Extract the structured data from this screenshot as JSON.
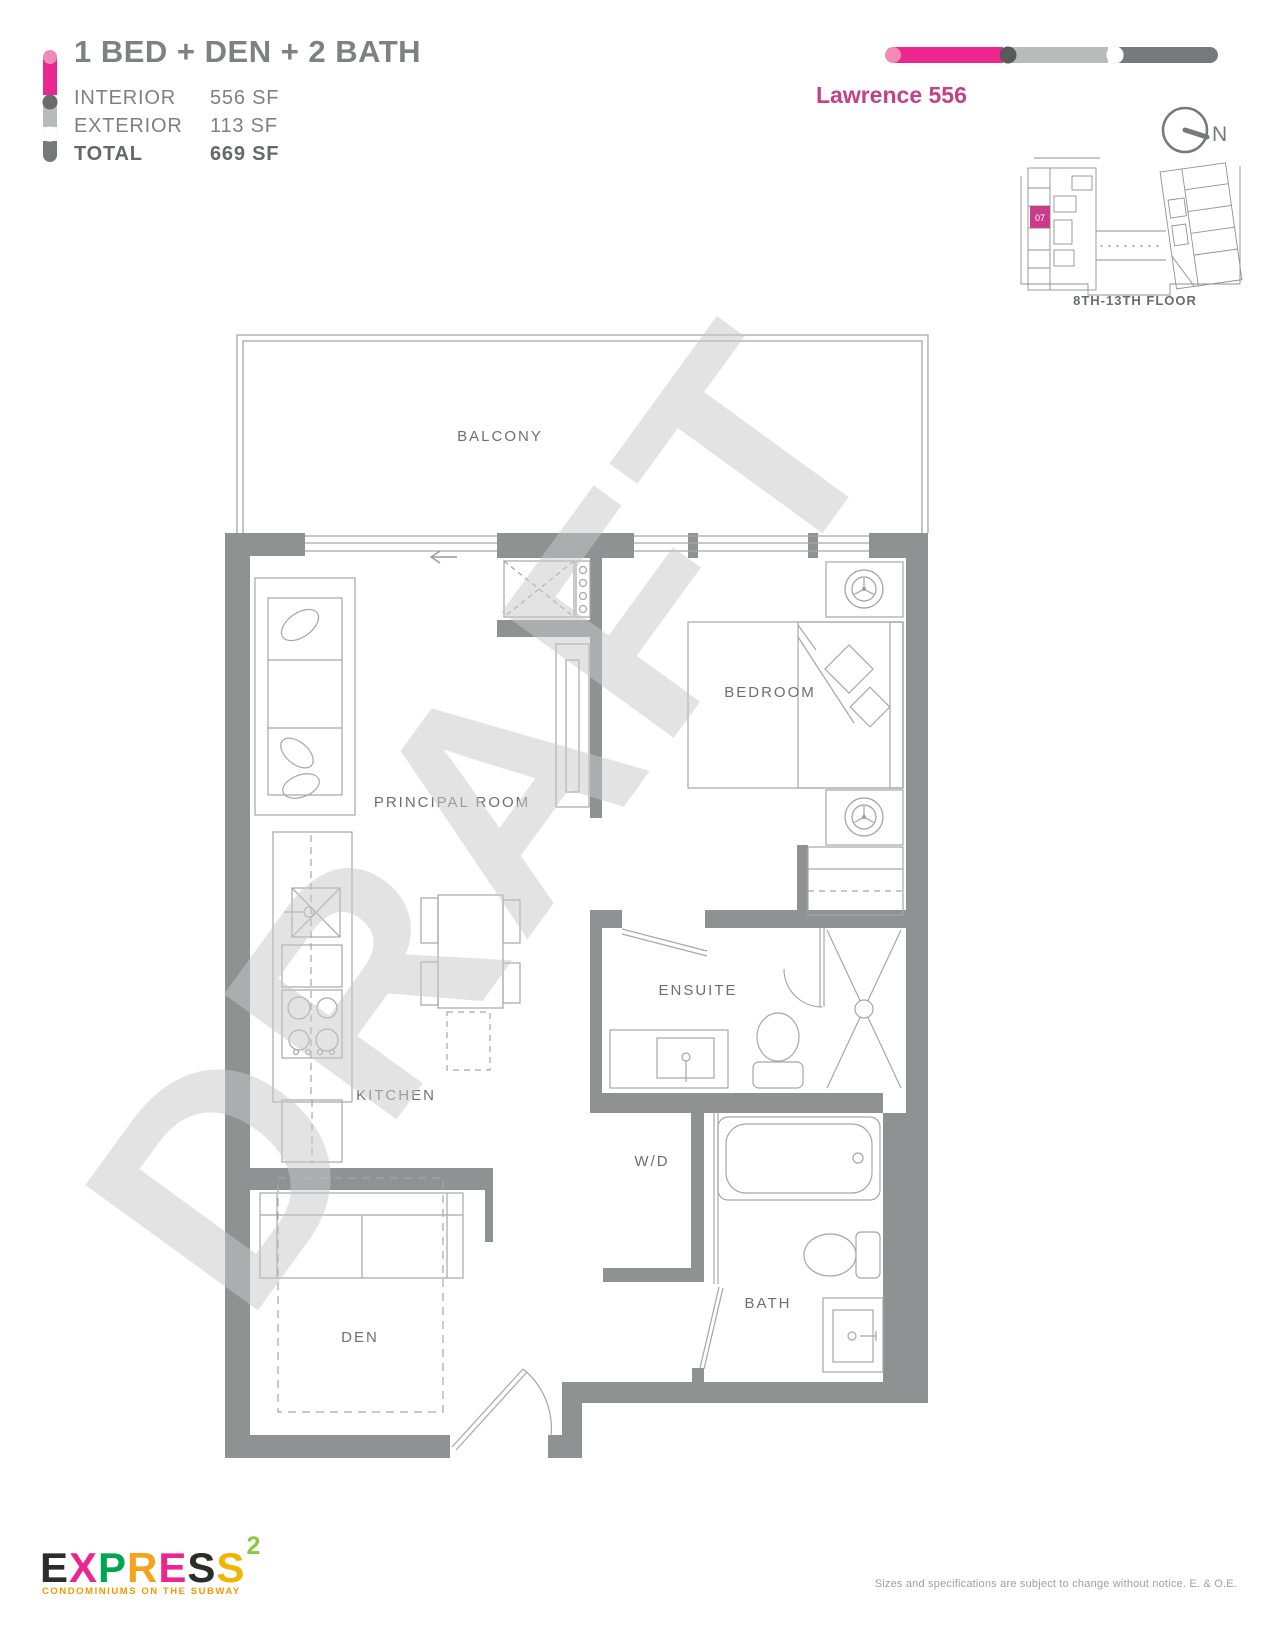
{
  "header": {
    "title": "1 BED + DEN + 2 BATH",
    "stats": [
      {
        "label": "INTERIOR",
        "value": "556 SF"
      },
      {
        "label": "EXTERIOR",
        "value": "113 SF"
      },
      {
        "label": "TOTAL",
        "value": "669 SF"
      }
    ],
    "plan_name": "Lawrence 556"
  },
  "keyplan": {
    "floor_range": "8TH-13TH FLOOR",
    "unit_number": "07",
    "compass_label": "N"
  },
  "floorplan": {
    "watermark": "DRAFT",
    "rooms": [
      {
        "label": "BALCONY"
      },
      {
        "label": "PRINCIPAL ROOM"
      },
      {
        "label": "BEDROOM"
      },
      {
        "label": "ENSUITE"
      },
      {
        "label": "KITCHEN"
      },
      {
        "label": "W/D"
      },
      {
        "label": "DEN"
      },
      {
        "label": "BATH"
      }
    ]
  },
  "footer": {
    "logo_letters": [
      "E",
      "X",
      "P",
      "R",
      "E",
      "S",
      "S"
    ],
    "logo_superscript": "2",
    "tagline": "CONDOMINIUMS ON THE SUBWAY",
    "disclaimer": "Sizes and specifications are subject to change without notice. E. & O.E."
  },
  "colors": {
    "accent_pink": "#EC268F",
    "light_pink_cap": "#F28AB6",
    "plan_name_pink": "#C2418A",
    "keyplan_unit_pink": "#CB3B8C",
    "wall_gray": "#8F9193",
    "line_gray": "#A6A6A6",
    "label_gray": "#6E6F71",
    "bar_dark_gray": "#77787B",
    "bar_light_gray": "#B9BABC",
    "watermark_gray": "#C9C9C9",
    "tagline_orange": "#F49A00"
  }
}
